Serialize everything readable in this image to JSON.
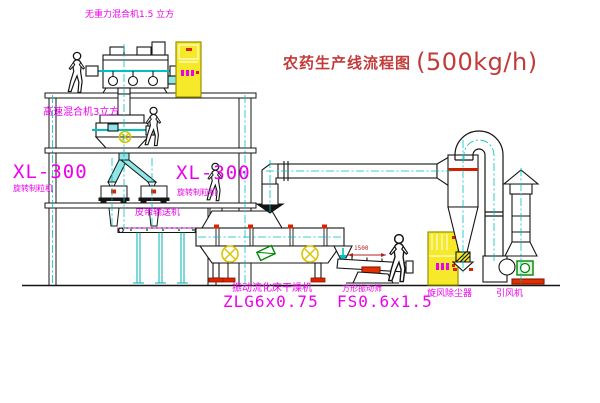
{
  "title": {
    "name": "农药生产线流程图",
    "capacity": "(500kg/h)"
  },
  "colors": {
    "label_magenta": "#ee00ee",
    "title_red": "#c23b3b",
    "centerline_cyan": "#00c0c0",
    "cabinet_yellow": "#f5e929",
    "alert_red": "#dd2200",
    "motor_green": "#008800"
  },
  "equipment": {
    "gravity_mixer": {
      "label": "无重力混合机1.5 立方"
    },
    "high_speed_mixer": {
      "label": "高速混合机3立方"
    },
    "granulator_left": {
      "model": "XL-300",
      "label": "旋转制粒机"
    },
    "granulator_right": {
      "model": "XL-300",
      "label": "旋转制粒机"
    },
    "belt_conveyor": {
      "label": "皮带输送机"
    },
    "dryer": {
      "label": "振动流化床干燥机",
      "model": "ZLG6x0.75"
    },
    "sieve": {
      "label": "方形振动筛",
      "model": "FS0.6x1.5",
      "dimension": "1500"
    },
    "cyclone": {
      "label": "旋风除尘器"
    },
    "fan": {
      "label": "引风机"
    }
  }
}
